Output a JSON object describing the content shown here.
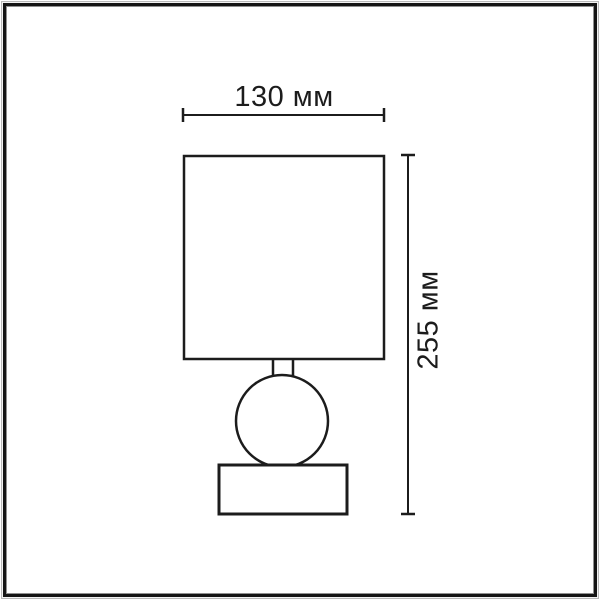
{
  "page": {
    "background_color": "#ffffff",
    "frame_color": "#141414",
    "frame_inner_line_color": "#8f8f8f",
    "line_color": "#1c1c1c"
  },
  "drawing": {
    "type": "product-dimension-diagram",
    "subject": "table-lamp-outline",
    "parts": [
      "lampshade",
      "neck",
      "spherical-body",
      "rectangular-base"
    ],
    "dimensions": {
      "width": {
        "value": 130,
        "unit": "мм",
        "label": "130 мм"
      },
      "height": {
        "value": 255,
        "unit": "мм",
        "label": "255 мм"
      }
    }
  }
}
